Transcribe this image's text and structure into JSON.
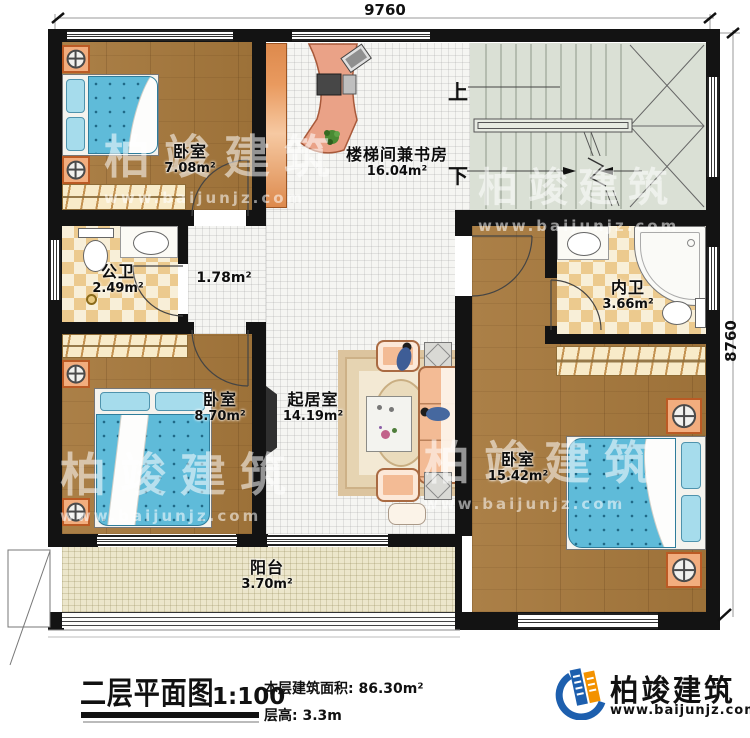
{
  "dimensions": {
    "top": "9760",
    "right": "8760"
  },
  "stairs": {
    "up": "上",
    "down": "下"
  },
  "rooms": {
    "bedroom_top_left": {
      "name": "卧室",
      "area": "7.08m²"
    },
    "study": {
      "name": "楼梯间兼书房",
      "area": "16.04m²"
    },
    "public_bath": {
      "name": "公卫",
      "area": "2.49m²"
    },
    "hall": {
      "area": "1.78m²"
    },
    "inner_bath": {
      "name": "内卫",
      "area": "3.66m²"
    },
    "bedroom_bottom_left": {
      "name": "卧室",
      "area": "8.70m²"
    },
    "living_room": {
      "name": "起居室",
      "area": "14.19m²"
    },
    "bedroom_right": {
      "name": "卧室",
      "area": "15.42m²"
    },
    "balcony": {
      "name": "阳台",
      "area": "3.70m²"
    }
  },
  "titleblock": {
    "title": "二层平面图",
    "scale": "1:100",
    "area_text": "本层建筑面积: 86.30m²",
    "floor_height": "层高: 3.3m"
  },
  "brand": {
    "name": "柏竣建筑",
    "site": "www.baijunjz.com",
    "blue": "#1d5fae",
    "orange": "#f39200"
  },
  "watermark": {
    "name": "柏竣建筑",
    "site": "www.baijunjz.com"
  }
}
